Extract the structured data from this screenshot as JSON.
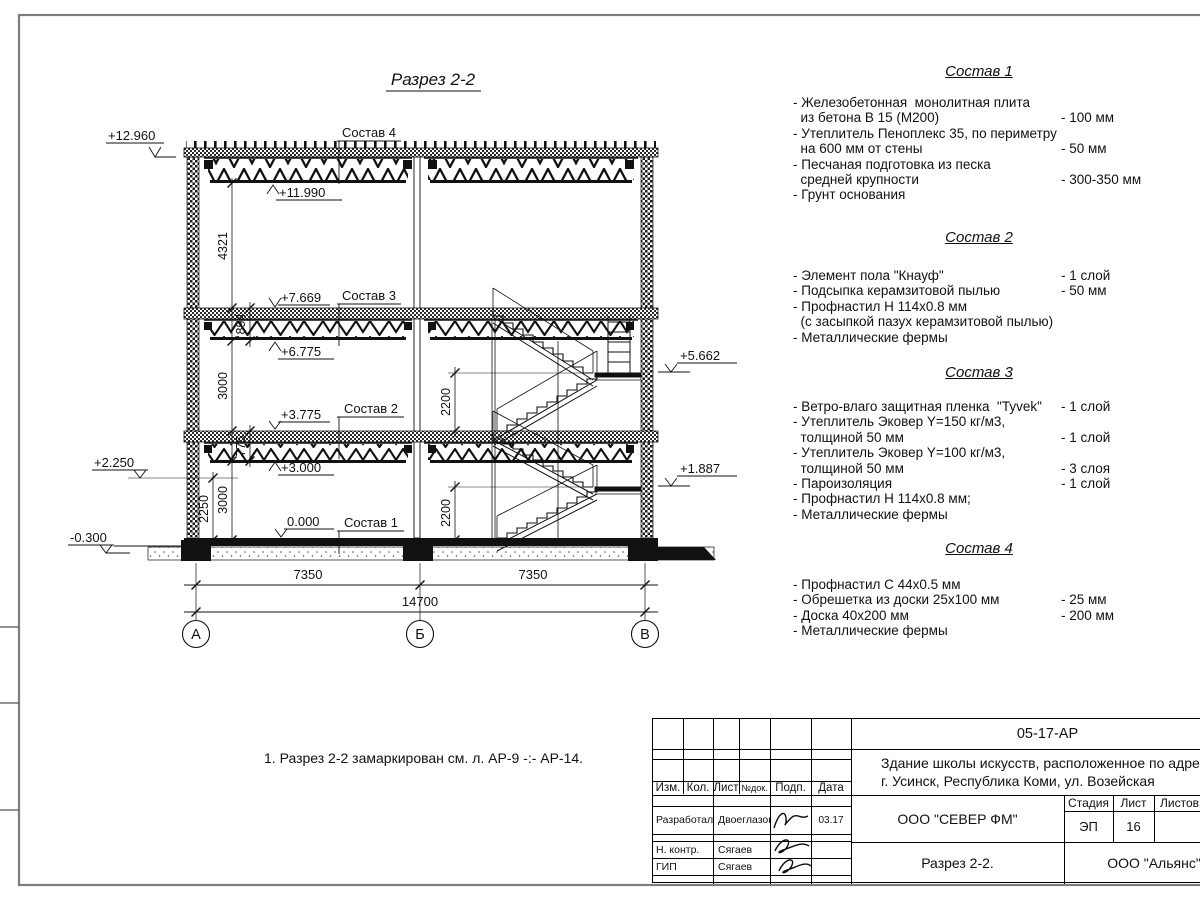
{
  "drawing": {
    "title": "Разрез 2-2",
    "note": "1. Разрез 2-2 замаркирован см. л. АР-9 -:- АР-14.",
    "callout1": "Состав 1",
    "callout2": "Состав 2",
    "callout3": "Состав 3",
    "callout4": "Состав 4",
    "elev": {
      "e12960": "+12.960",
      "e11990": "+11.990",
      "e7669": "+7.669",
      "e6775": "+6.775",
      "e3775": "+3.775",
      "e3000": "+3.000",
      "e0": "0.000",
      "em0300": "-0.300",
      "e2250": "+2.250",
      "e5662": "+5.662",
      "e1887": "+1.887"
    },
    "dims": {
      "d4321": "4321",
      "d894": "894",
      "d3000a": "3000",
      "d3000b": "3000",
      "d775": "775",
      "d2250": "2250",
      "d2200a": "2200",
      "d2200b": "2200",
      "w1": "7350",
      "w2": "7350",
      "total": "14700"
    },
    "axes": [
      "А",
      "Б",
      "В"
    ]
  },
  "sostav1": {
    "title": "Состав 1",
    "rows": [
      {
        "t": "- Железобетонная  монолитная плита",
        "v": ""
      },
      {
        "t": "  из бетона В 15 (М200)",
        "v": "- 100 мм"
      },
      {
        "t": "- Утеплитель Пеноплекс 35, по периметру",
        "v": ""
      },
      {
        "t": "  на 600 мм от стены",
        "v": "- 50 мм"
      },
      {
        "t": "- Песчаная подготовка из песка",
        "v": ""
      },
      {
        "t": "  средней крупности",
        "v": "- 300-350 мм"
      },
      {
        "t": "- Грунт основания",
        "v": ""
      }
    ]
  },
  "sostav2": {
    "title": "Состав 2",
    "rows": [
      {
        "t": "- Элемент пола \"Кнауф\"",
        "v": "- 1 слой"
      },
      {
        "t": "- Подсыпка керамзитовой пылью",
        "v": "- 50 мм"
      },
      {
        "t": "- Профнастил Н 114х0.8 мм",
        "v": ""
      },
      {
        "t": "  (с засыпкой пазух керамзитовой пылью)",
        "v": ""
      },
      {
        "t": "- Металлические фермы",
        "v": ""
      }
    ]
  },
  "sostav3": {
    "title": "Состав 3",
    "rows": [
      {
        "t": "- Ветро-влаго защитная пленка  \"Tyvek\"",
        "v": "- 1 слой"
      },
      {
        "t": "- Утеплитель Эковер Y=150 кг/м3,",
        "v": ""
      },
      {
        "t": "  толщиной 50 мм",
        "v": "- 1 слой"
      },
      {
        "t": "- Утеплитель Эковер Y=100 кг/м3,",
        "v": ""
      },
      {
        "t": "  толщиной 50 мм",
        "v": "- 3 слоя"
      },
      {
        "t": "- Пароизоляция",
        "v": "- 1 слой"
      },
      {
        "t": "- Профнастил Н 114х0.8 мм;",
        "v": ""
      },
      {
        "t": "- Металлические фермы",
        "v": ""
      }
    ]
  },
  "sostav4": {
    "title": "Состав 4",
    "rows": [
      {
        "t": "- Профнастил С 44х0.5 мм",
        "v": ""
      },
      {
        "t": "- Обрешетка из доски 25х100 мм",
        "v": "- 25 мм"
      },
      {
        "t": "- Доска 40х200 мм",
        "v": "- 200 мм"
      },
      {
        "t": "- Металлические фермы",
        "v": ""
      }
    ]
  },
  "stamp": {
    "doc_number": "05-17-АР",
    "project_line1": "Здание школы искусств, расположенное по адресу:",
    "project_line2": "г. Усинск, Республика Коми, ул. Возейская",
    "org": "ООО \"СЕВЕР ФМ\"",
    "sheet_title": "Разрез 2-2.",
    "contractor": "ООО \"Альянс\"",
    "stage_label": "Стадия",
    "sheet_label": "Лист",
    "sheets_label": "Листов",
    "stage": "ЭП",
    "sheet_no": "16",
    "cols": {
      "izm": "Изм.",
      "kol": "Кол.",
      "list": "Лист",
      "doc": "№док.",
      "podp": "Подп.",
      "data": "Дата"
    },
    "sig_rows": [
      {
        "role": "Разработал",
        "name": "Двоеглазов",
        "date": "03.17"
      },
      {
        "role": "Н. контр.",
        "name": "Сягаев",
        "date": ""
      },
      {
        "role": "ГИП",
        "name": "Сягаев",
        "date": ""
      }
    ]
  }
}
